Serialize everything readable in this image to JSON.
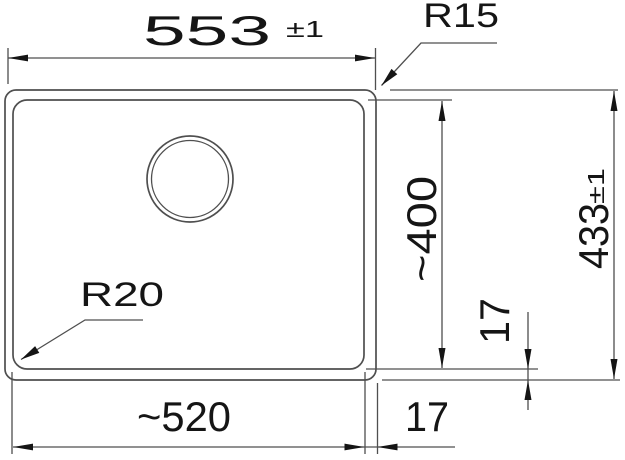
{
  "colors": {
    "background": "#ffffff",
    "line": "#4f4f4f",
    "text": "#151515"
  },
  "drawing": {
    "dimension_labels": {
      "outer_width": "553",
      "outer_width_tolerance": "±1",
      "corner_radius_top_right": "R15",
      "outer_height": "433",
      "outer_height_tolerance": "±1",
      "inner_height": "~400",
      "rim_offset_right": "17",
      "corner_radius_bottom_left": "R20",
      "inner_width": "~520",
      "rim_offset_bottom": "17"
    }
  }
}
